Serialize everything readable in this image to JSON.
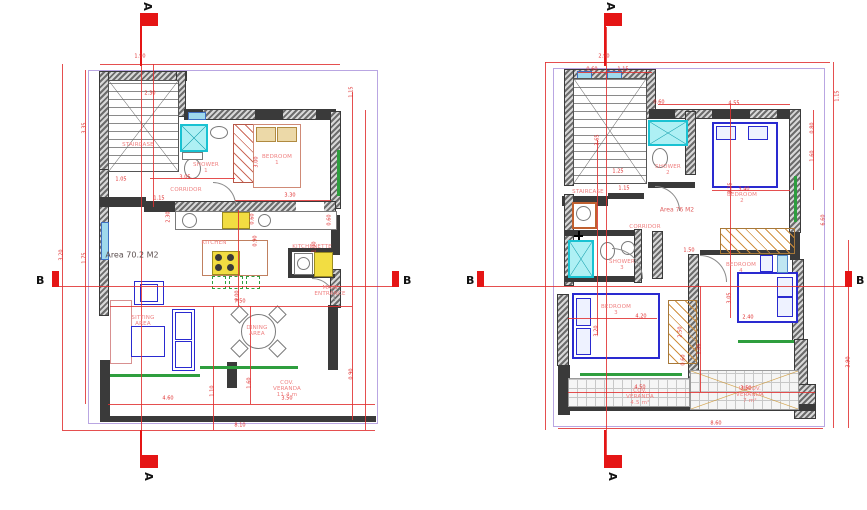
{
  "drawing_title": "Two-storey house floor plans",
  "colors": {
    "dimension_red": "#e03030",
    "wall_dark": "#3a3a3a",
    "furniture_blue": "#2a2ad0",
    "window_cyan": "#9fd9ec",
    "shower_cyan": "#19c2d2",
    "door_green": "#2e9e3e",
    "wardrobe_orange": "#d09040",
    "marker_red": "#e51515",
    "background": "#ffffff"
  },
  "plans": [
    {
      "name": "ground-floor-plan",
      "area_label": "Area 70.2 M2",
      "markers": {
        "top": "A",
        "bottom": "A",
        "left": "B",
        "right": "B"
      },
      "room_labels": [
        {
          "text": "STAIRCASE",
          "x": 138,
          "y": 145
        },
        {
          "text": "SHOWER 1",
          "x": 206,
          "y": 168
        },
        {
          "text": "BEDROOM 1",
          "x": 277,
          "y": 160
        },
        {
          "text": "CORRIDOR",
          "x": 186,
          "y": 190
        },
        {
          "text": "KITCHEN",
          "x": 214,
          "y": 243
        },
        {
          "text": "KITCHENETTE",
          "x": 312,
          "y": 247
        },
        {
          "text": "MAIN\nENTRANCE",
          "x": 330,
          "y": 291
        },
        {
          "text": "SITTING AREA",
          "x": 143,
          "y": 321
        },
        {
          "text": "DINING AREA",
          "x": 257,
          "y": 331
        },
        {
          "text": "COV. VERANDA 11.4 m",
          "x": 287,
          "y": 389
        }
      ],
      "dim_labels": [
        {
          "text": "1.90",
          "x": 140,
          "y": 57
        },
        {
          "text": "2.30",
          "x": 150,
          "y": 94
        },
        {
          "text": "1.15",
          "x": 352,
          "y": 92,
          "rot": true
        },
        {
          "text": "3.35",
          "x": 85,
          "y": 128,
          "rot": true
        },
        {
          "text": "3.00",
          "x": 257,
          "y": 162,
          "rot": true
        },
        {
          "text": "3.30",
          "x": 290,
          "y": 196
        },
        {
          "text": "3.05",
          "x": 185,
          "y": 178
        },
        {
          "text": "1.05",
          "x": 121,
          "y": 180
        },
        {
          "text": "1.15",
          "x": 159,
          "y": 199
        },
        {
          "text": "2.30",
          "x": 169,
          "y": 217,
          "rot": true
        },
        {
          "text": "0.60",
          "x": 253,
          "y": 219,
          "rot": true
        },
        {
          "text": "0.90",
          "x": 256,
          "y": 241,
          "rot": true
        },
        {
          "text": "0.60",
          "x": 330,
          "y": 220,
          "rot": true
        },
        {
          "text": "1.00",
          "x": 315,
          "y": 247,
          "rot": true
        },
        {
          "text": "4.00",
          "x": 238,
          "y": 296,
          "rot": true
        },
        {
          "text": "7.50",
          "x": 240,
          "y": 302
        },
        {
          "text": "1.75",
          "x": 85,
          "y": 258,
          "rot": true
        },
        {
          "text": "3.20",
          "x": 62,
          "y": 255,
          "rot": true
        },
        {
          "text": "1.10",
          "x": 213,
          "y": 391,
          "rot": true
        },
        {
          "text": "1.60",
          "x": 250,
          "y": 383,
          "rot": true
        },
        {
          "text": "0.90",
          "x": 352,
          "y": 374,
          "rot": true
        },
        {
          "text": "4.60",
          "x": 168,
          "y": 399
        },
        {
          "text": "3.50",
          "x": 287,
          "y": 399
        },
        {
          "text": "8.10",
          "x": 240,
          "y": 426
        }
      ]
    },
    {
      "name": "first-floor-plan",
      "area_label": "Area 76 M2",
      "markers": {
        "top": "A",
        "bottom": "A",
        "left": "B",
        "right": "B"
      },
      "room_labels": [
        {
          "text": "STAIRCASE",
          "x": 588,
          "y": 192
        },
        {
          "text": "SHOWER 2",
          "x": 668,
          "y": 170
        },
        {
          "text": "BEDROOM 2",
          "x": 742,
          "y": 198
        },
        {
          "text": "CORRIDOR",
          "x": 645,
          "y": 227
        },
        {
          "text": "SHOWER 3",
          "x": 622,
          "y": 265
        },
        {
          "text": "BEDROOM 3",
          "x": 616,
          "y": 310
        },
        {
          "text": "BEDROOM 4",
          "x": 741,
          "y": 268
        },
        {
          "text": "COV. VERANDA 4.5 m²",
          "x": 640,
          "y": 397
        },
        {
          "text": "UNCOV. VERANDA 7 m²",
          "x": 750,
          "y": 395
        }
      ],
      "dim_labels": [
        {
          "text": "2.90",
          "x": 604,
          "y": 57
        },
        {
          "text": "0.60",
          "x": 592,
          "y": 70
        },
        {
          "text": "1.15",
          "x": 623,
          "y": 70
        },
        {
          "text": "3.65",
          "x": 598,
          "y": 140,
          "rot": true
        },
        {
          "text": "0.60",
          "x": 659,
          "y": 103
        },
        {
          "text": "4.55",
          "x": 734,
          "y": 104
        },
        {
          "text": "1.15",
          "x": 838,
          "y": 96,
          "rot": true
        },
        {
          "text": "0.80",
          "x": 813,
          "y": 128,
          "rot": true
        },
        {
          "text": "1.60",
          "x": 813,
          "y": 156,
          "rot": true
        },
        {
          "text": "1.25",
          "x": 618,
          "y": 172
        },
        {
          "text": "1.15",
          "x": 624,
          "y": 189
        },
        {
          "text": "3.25",
          "x": 731,
          "y": 188,
          "rot": true
        },
        {
          "text": "3.40",
          "x": 744,
          "y": 190
        },
        {
          "text": "6.60",
          "x": 824,
          "y": 220,
          "rot": true
        },
        {
          "text": "1.50",
          "x": 689,
          "y": 251
        },
        {
          "text": "3.05",
          "x": 730,
          "y": 298,
          "rot": true
        },
        {
          "text": "2.40",
          "x": 748,
          "y": 318
        },
        {
          "text": "4.20",
          "x": 641,
          "y": 317
        },
        {
          "text": "3.20",
          "x": 597,
          "y": 331,
          "rot": true
        },
        {
          "text": "2.50",
          "x": 681,
          "y": 332,
          "rot": true
        },
        {
          "text": "0.60",
          "x": 684,
          "y": 360,
          "rot": true
        },
        {
          "text": "1.00",
          "x": 700,
          "y": 349,
          "rot": true
        },
        {
          "text": "3.90",
          "x": 849,
          "y": 362,
          "rot": true
        },
        {
          "text": "4.50",
          "x": 640,
          "y": 388
        },
        {
          "text": "3.50",
          "x": 746,
          "y": 389
        },
        {
          "text": "8.60",
          "x": 716,
          "y": 424
        }
      ]
    }
  ]
}
